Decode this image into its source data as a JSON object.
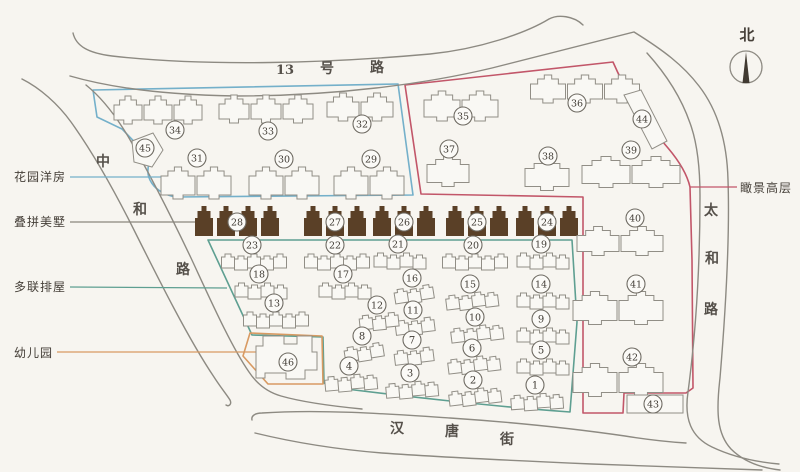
{
  "plan_title": "residential community site plan",
  "compass": {
    "label": "北"
  },
  "roads": {
    "north": {
      "name": "13号路",
      "chars": [
        {
          "t": "13",
          "x": 285,
          "y": 74
        },
        {
          "t": "号",
          "x": 327,
          "y": 73
        },
        {
          "t": "路",
          "x": 377,
          "y": 72
        }
      ]
    },
    "west": {
      "name": "中和路",
      "chars": [
        {
          "t": "中",
          "x": 103,
          "y": 166
        },
        {
          "t": "和",
          "x": 140,
          "y": 214
        },
        {
          "t": "路",
          "x": 183,
          "y": 274
        }
      ]
    },
    "east": {
      "name": "太和路",
      "chars": [
        {
          "t": "太",
          "x": 711,
          "y": 215
        },
        {
          "t": "和",
          "x": 712,
          "y": 263
        },
        {
          "t": "路",
          "x": 711,
          "y": 314
        }
      ]
    },
    "south": {
      "name": "汉唐街",
      "chars": [
        {
          "t": "汉",
          "x": 397,
          "y": 433
        },
        {
          "t": "唐",
          "x": 452,
          "y": 436
        },
        {
          "t": "街",
          "x": 507,
          "y": 444
        }
      ]
    }
  },
  "legend": [
    {
      "id": "garden",
      "label": "花园洋房",
      "color": "#74b0ca",
      "text_x": 14,
      "text_y": 181,
      "line": [
        70,
        177,
        163,
        177
      ]
    },
    {
      "id": "villa",
      "label": "叠拼美墅",
      "color": "#8a867e",
      "text_x": 14,
      "text_y": 226,
      "line": [
        70,
        222,
        199,
        222
      ]
    },
    {
      "id": "townhouse",
      "label": "多联排屋",
      "color": "#5e9f91",
      "text_x": 14,
      "text_y": 291,
      "line": [
        70,
        287,
        227,
        288
      ]
    },
    {
      "id": "kindergarten",
      "label": "幼儿园",
      "color": "#d89a62",
      "text_x": 14,
      "text_y": 357,
      "line": [
        57,
        352,
        257,
        352
      ]
    },
    {
      "id": "highrise",
      "label": "瞰景高层",
      "color": "#c25669",
      "text_x": 740,
      "text_y": 192,
      "line": [
        690,
        187,
        737,
        187
      ]
    }
  ],
  "zone_colors": {
    "garden": "#74b0ca",
    "townhouse": "#5e9f91",
    "kindergarten": "#d89a62",
    "highrise": "#c25669",
    "villa": "#5a4027"
  },
  "markers": [
    {
      "no": "1",
      "x": 535,
      "y": 385,
      "zone": "townhouse"
    },
    {
      "no": "2",
      "x": 473,
      "y": 380,
      "zone": "townhouse"
    },
    {
      "no": "3",
      "x": 410,
      "y": 373,
      "zone": "townhouse"
    },
    {
      "no": "4",
      "x": 349,
      "y": 366,
      "zone": "townhouse"
    },
    {
      "no": "5",
      "x": 541,
      "y": 350,
      "zone": "townhouse"
    },
    {
      "no": "6",
      "x": 472,
      "y": 348,
      "zone": "townhouse"
    },
    {
      "no": "7",
      "x": 412,
      "y": 340,
      "zone": "townhouse"
    },
    {
      "no": "8",
      "x": 362,
      "y": 336,
      "zone": "townhouse"
    },
    {
      "no": "9",
      "x": 541,
      "y": 319,
      "zone": "townhouse"
    },
    {
      "no": "10",
      "x": 475,
      "y": 317,
      "zone": "townhouse"
    },
    {
      "no": "11",
      "x": 413,
      "y": 310,
      "zone": "townhouse"
    },
    {
      "no": "12",
      "x": 377,
      "y": 305,
      "zone": "townhouse"
    },
    {
      "no": "13",
      "x": 274,
      "y": 303,
      "zone": "townhouse"
    },
    {
      "no": "14",
      "x": 541,
      "y": 284,
      "zone": "townhouse"
    },
    {
      "no": "15",
      "x": 470,
      "y": 284,
      "zone": "townhouse"
    },
    {
      "no": "16",
      "x": 412,
      "y": 278,
      "zone": "townhouse"
    },
    {
      "no": "17",
      "x": 343,
      "y": 274,
      "zone": "townhouse"
    },
    {
      "no": "18",
      "x": 259,
      "y": 274,
      "zone": "townhouse"
    },
    {
      "no": "19",
      "x": 541,
      "y": 244,
      "zone": "townhouse"
    },
    {
      "no": "20",
      "x": 473,
      "y": 245,
      "zone": "townhouse"
    },
    {
      "no": "21",
      "x": 398,
      "y": 244,
      "zone": "townhouse"
    },
    {
      "no": "22",
      "x": 335,
      "y": 245,
      "zone": "townhouse"
    },
    {
      "no": "23",
      "x": 252,
      "y": 245,
      "zone": "townhouse"
    },
    {
      "no": "24",
      "x": 547,
      "y": 222,
      "zone": "villa"
    },
    {
      "no": "25",
      "x": 477,
      "y": 222,
      "zone": "villa"
    },
    {
      "no": "26",
      "x": 404,
      "y": 222,
      "zone": "villa"
    },
    {
      "no": "27",
      "x": 335,
      "y": 222,
      "zone": "villa"
    },
    {
      "no": "28",
      "x": 237,
      "y": 222,
      "zone": "villa"
    },
    {
      "no": "29",
      "x": 371,
      "y": 159,
      "zone": "garden"
    },
    {
      "no": "30",
      "x": 284,
      "y": 159,
      "zone": "garden"
    },
    {
      "no": "31",
      "x": 197,
      "y": 158,
      "zone": "garden"
    },
    {
      "no": "32",
      "x": 362,
      "y": 124,
      "zone": "garden"
    },
    {
      "no": "33",
      "x": 268,
      "y": 131,
      "zone": "garden"
    },
    {
      "no": "34",
      "x": 175,
      "y": 130,
      "zone": "garden"
    },
    {
      "no": "35",
      "x": 463,
      "y": 116,
      "zone": "highrise"
    },
    {
      "no": "36",
      "x": 577,
      "y": 103,
      "zone": "highrise"
    },
    {
      "no": "37",
      "x": 449,
      "y": 149,
      "zone": "highrise"
    },
    {
      "no": "38",
      "x": 548,
      "y": 156,
      "zone": "highrise"
    },
    {
      "no": "39",
      "x": 631,
      "y": 150,
      "zone": "highrise"
    },
    {
      "no": "40",
      "x": 635,
      "y": 218,
      "zone": "highrise"
    },
    {
      "no": "41",
      "x": 636,
      "y": 284,
      "zone": "highrise"
    },
    {
      "no": "42",
      "x": 632,
      "y": 357,
      "zone": "highrise"
    },
    {
      "no": "43",
      "x": 653,
      "y": 404,
      "zone": "highrise"
    },
    {
      "no": "44",
      "x": 642,
      "y": 119,
      "zone": "highrise"
    },
    {
      "no": "45",
      "x": 145,
      "y": 148,
      "zone": "garden"
    },
    {
      "no": "46",
      "x": 288,
      "y": 362,
      "zone": "kindergarten"
    }
  ]
}
